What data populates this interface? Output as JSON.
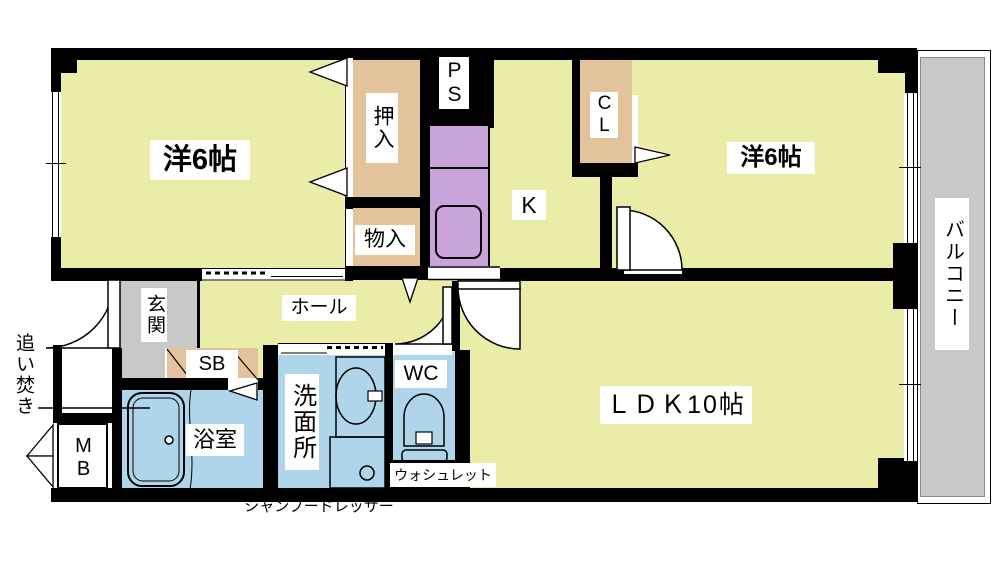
{
  "plan": {
    "rooms": {
      "bedroom1": "洋6帖",
      "bedroom2": "洋6帖",
      "kitchen": "K",
      "ldk": "ＬＤＫ10帖",
      "hall": "ホール",
      "genkan": "玄関",
      "bath": "浴室",
      "washroom": "洗面所",
      "wc": "WC",
      "balcony": "バルコニー"
    },
    "storage": {
      "oshiire": "押入",
      "monoire": "物入",
      "closet": "CL",
      "shoe_box": "SB",
      "pipe_space": "PS",
      "meter_box": "MB"
    },
    "annotations": {
      "oidaki": "追い焚き",
      "washlet": "ウォシュレット",
      "shampoo_dresser": "シャンプードレッサー"
    },
    "colors": {
      "floor": "#e9eda7",
      "storage": "#e3c39c",
      "kitchen_unit": "#c9a3dc",
      "wet_area": "#aed5e9",
      "concrete": "#c8c8c8",
      "wall": "#000000"
    }
  }
}
